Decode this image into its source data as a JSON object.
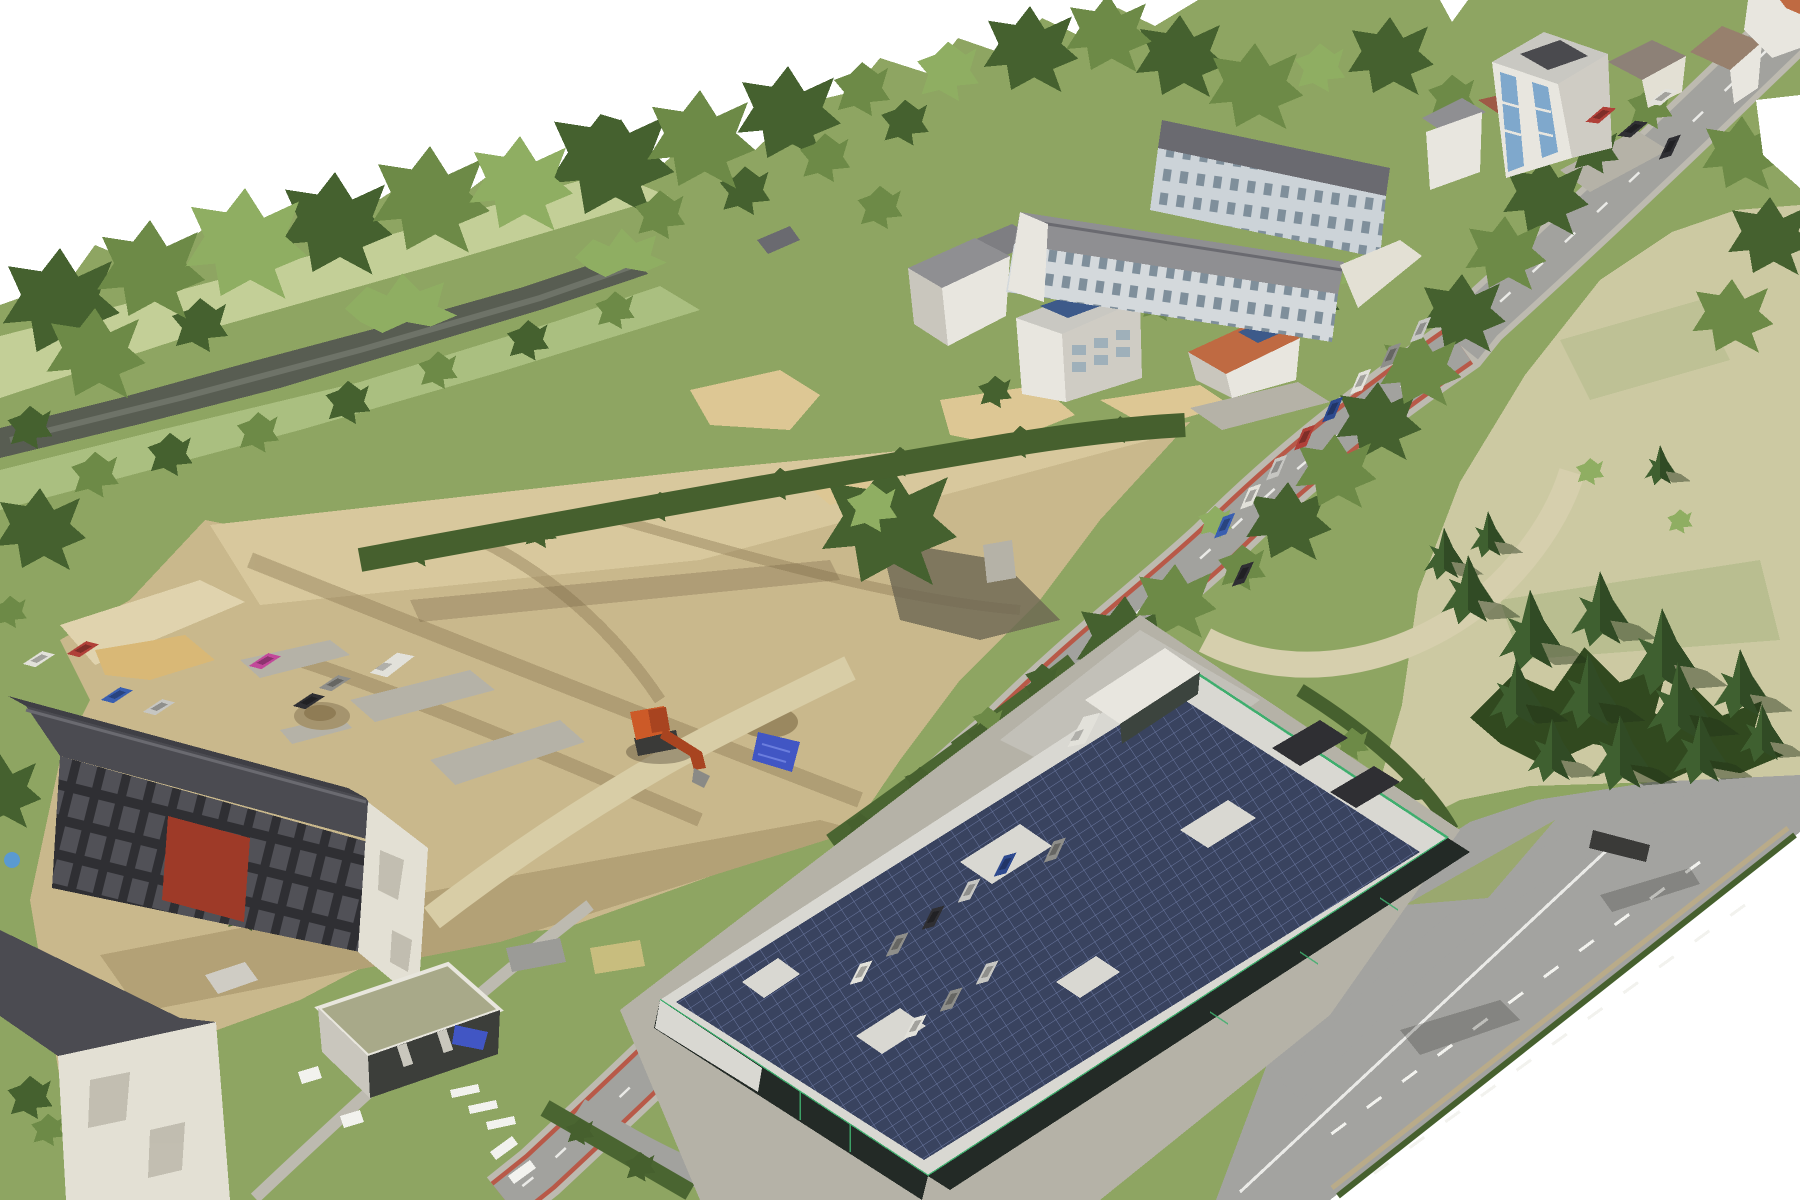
{
  "meta": {
    "kind": "aerial-3d-photogrammetry-mesh",
    "description": "Oblique aerial 3D textured mesh of a town block: cleared construction site with excavator, main street with red bike lanes, apartment blocks, car-dealership building with rooftop solar array, dry field with conifers, river with tree band, white void outside mesh"
  },
  "colors": {
    "background": "#ffffff",
    "terrain_base": "#8ea562",
    "meadow_light": "#c3cf97",
    "meadow_mid": "#aabf80",
    "river": "#585d52",
    "river_light": "#6e7368",
    "dirt": "#c9b88c",
    "dirt_light": "#d8c89d",
    "dirt_pale": "#e0d3ae",
    "dirt_dark": "#b3a176",
    "track_brown": "#8a7752",
    "concrete": "#b5b2a7",
    "sand": "#ddc794",
    "sand_yellow": "#d9b876",
    "haul_path": "#d8cda6",
    "field": "#ccc9a2",
    "field_green": "#b4bc8c",
    "field_path": "#d6cfad",
    "asphalt": "#a2a29e",
    "sidewalk": "#bdbab0",
    "lane_red": "#b85948",
    "lane_white": "#f2f2ee",
    "road_big": "#a3a3a0",
    "hedge": "#46602e",
    "hedge2": "#4a6531",
    "tree_dark": "#45612f",
    "tree_mid": "#6d8a47",
    "tree_light": "#8fae62",
    "conifer": "#3f6030",
    "under_canopy": "#31491f",
    "roof_dark": "#4b4b51",
    "roof_dark2": "#3f3f45",
    "ridge": "#6a6a70",
    "roof_gray": "#8f8f92",
    "roof_gray2": "#7e7e82",
    "roof_light": "#c9c8c2",
    "roof_flat": "#d9d8d2",
    "tile_orange": "#bf6a42",
    "tile_red": "#9e5a46",
    "roof_brown": "#97806d",
    "roof_tan": "#8d8177",
    "wall_white": "#e8e6df",
    "wall_cream": "#e3e0d4",
    "wall_shade": "#cfccc4",
    "wall_dark": "#c9c6bd",
    "facade_red": "#9e3a28",
    "facade_dark": "#2f2f33",
    "balcony": "#515157",
    "complex_facade": "#ccd3d8",
    "complex_facade2": "#d4d9dc",
    "glass_blue": "#7fa8cc",
    "solar": "#3d5a8a",
    "solar_dark": "#39435f",
    "dealer_glass": "#232a26",
    "dealer_green": "#3fae6e",
    "excavator": "#cc5a28",
    "excavator_dark": "#a84420",
    "machine_dark": "#3a3a38",
    "tarp": "#4156c4",
    "pool_blue": "#5a9ad0",
    "shadow_dark": "#6d6653"
  },
  "cars": {
    "white": "#e2e1da",
    "silver": "#c6c6c2",
    "gray": "#8e8e8a",
    "dark": "#2f2f33",
    "red": "#b04038",
    "blue": "#3a5fb0",
    "navy": "#2e4a8f",
    "magenta": "#c2489a"
  },
  "scene": {
    "objects": [
      "construction-site",
      "excavator",
      "blue-tarp",
      "sand-piles",
      "main-street-with-red-bike-lanes",
      "bottom-highway",
      "field-access-road",
      "apartment-complex",
      "residential-tower-blue-balconies",
      "hip-roof-houses",
      "white-house-solar-roof",
      "orange-roof-house-solar",
      "demolition-apartment-block-red-facade",
      "apartment-block-bottom-left",
      "flat-green-roof-building",
      "car-dealership-solar-roof",
      "parking-rows",
      "river",
      "forest-band",
      "dry-field",
      "conifer-cluster",
      "parked-cars"
    ]
  }
}
